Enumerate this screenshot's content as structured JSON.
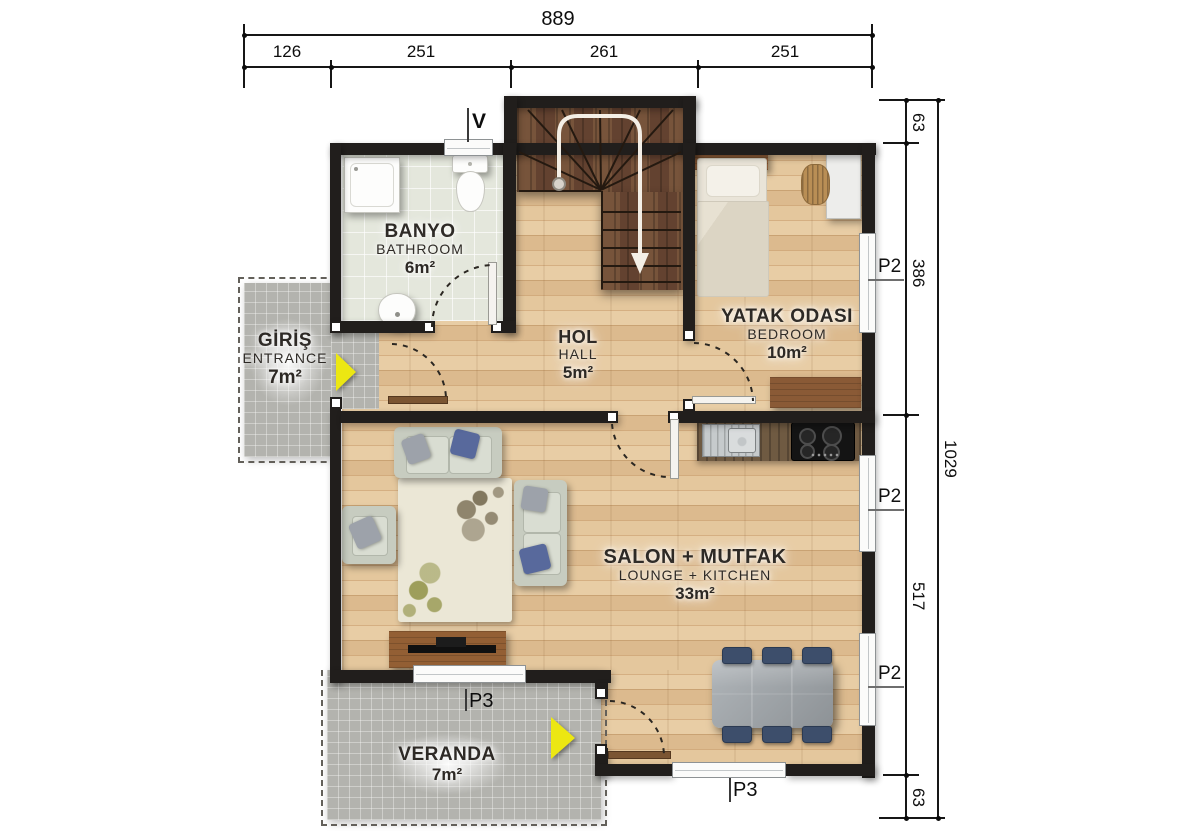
{
  "dimensions": {
    "top": {
      "total": "889",
      "segments": [
        "126",
        "251",
        "261",
        "251"
      ]
    },
    "right": {
      "total": "1029",
      "segments": [
        "63",
        "386",
        "517",
        "63"
      ]
    }
  },
  "markers": {
    "vent": "V",
    "window_p2": "P2",
    "window_p3": "P3"
  },
  "rooms": {
    "bathroom": {
      "name_tr": "BANYO",
      "name_en": "BATHROOM",
      "area": "6m²"
    },
    "entrance": {
      "name_tr": "GİRİŞ",
      "name_en": "ENTRANCE",
      "area": "7m²"
    },
    "hall": {
      "name_tr": "HOL",
      "name_en": "HALL",
      "area": "5m²"
    },
    "bedroom": {
      "name_tr": "YATAK ODASI",
      "name_en": "BEDROOM",
      "area": "10m²"
    },
    "lounge_kitchen": {
      "name_tr": "SALON + MUTFAK",
      "name_en": "LOUNGE + KITCHEN",
      "area": "33m²"
    },
    "veranda": {
      "name_tr": "VERANDA",
      "area": "7m²"
    }
  },
  "colors": {
    "wall": "#211e1c",
    "wood_floor": "#dcbc90",
    "stair_wood": "#6b4a33",
    "bath_tile": "#e4e7dc",
    "patio_gray": "#b3b3ae",
    "entry_arrow_yellow": "#ece712",
    "dining_chair_navy": "#3d4e6b"
  }
}
